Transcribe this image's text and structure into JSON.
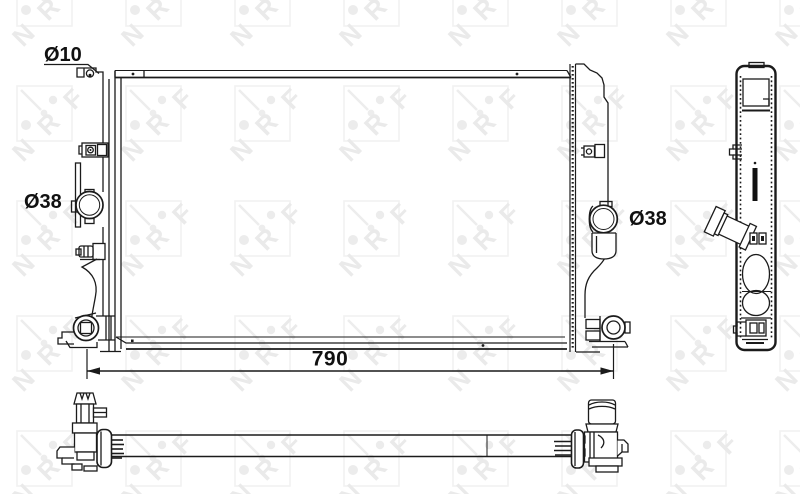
{
  "drawing_type": "radiator-technical-drawing",
  "labels": {
    "hole_diameter": "Ø10",
    "left_port_diameter": "Ø38",
    "right_port_diameter": "Ø38",
    "overall_width": "790"
  },
  "watermark": {
    "letter_n": "N",
    "letter_r": "R",
    "letter_f": "F"
  },
  "colors": {
    "line": "#1b1b1b",
    "watermark": "#ececec",
    "watermark_light": "#f2f2f2",
    "background": "#ffffff"
  }
}
